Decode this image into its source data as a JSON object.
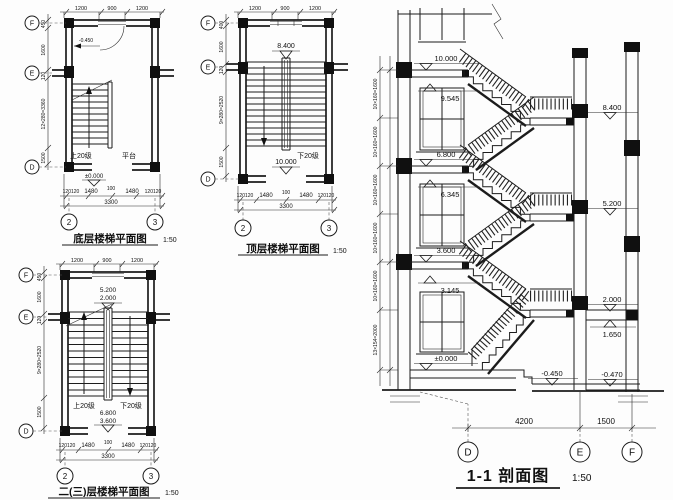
{
  "plans": {
    "ground": {
      "caption": "底层楼梯平面图",
      "scale": "1:50",
      "dims_top": [
        "1200",
        "900",
        "1200"
      ],
      "dims_left": [
        "450",
        "1600",
        "120",
        "12×280=3360",
        "1500"
      ],
      "dims_bottom": [
        "120120",
        "1480",
        "100",
        "1480",
        "120120"
      ],
      "dim_total": "3300",
      "axes_left": [
        "F",
        "E",
        "D"
      ],
      "axes_bottom": [
        "2",
        "3"
      ],
      "label_up": "上20级",
      "label_landing": "平台",
      "level_zero": "±0.000",
      "level_entry": "-0.450"
    },
    "top": {
      "caption": "顶层楼梯平面图",
      "scale": "1:50",
      "dims_top": [
        "1200",
        "900",
        "1200"
      ],
      "dims_left": [
        "400",
        "1600",
        "120",
        "9×280=2520",
        "1500"
      ],
      "dims_bottom": [
        "120120",
        "1480",
        "100",
        "1480",
        "120120"
      ],
      "dim_total": "3300",
      "axes_left": [
        "F",
        "E",
        "D"
      ],
      "axes_bottom": [
        "2",
        "3"
      ],
      "label_down": "下20级",
      "level_landing": "8.400",
      "level_floor": "10.000"
    },
    "middle": {
      "caption": "二(三)层楼梯平面图",
      "scale": "1:50",
      "dims_top": [
        "1200",
        "900",
        "1200"
      ],
      "dims_left": [
        "450",
        "1600",
        "120",
        "9×280=2520",
        "1500"
      ],
      "dims_bottom": [
        "120120",
        "1480",
        "100",
        "1480",
        "120120"
      ],
      "dim_total": "3300",
      "axes_left": [
        "F",
        "E",
        "D"
      ],
      "axes_bottom": [
        "2",
        "3"
      ],
      "label_up": "上20级",
      "label_down": "下20级",
      "levels_top": [
        "5.200",
        "2.000"
      ],
      "levels_bottom": [
        "6.800",
        "3.600"
      ]
    }
  },
  "section": {
    "caption": "1-1 剖面图",
    "scale": "1:50",
    "levels_left": [
      "10.000",
      "9.545",
      "6.800",
      "6.345",
      "3.600",
      "3.145",
      "±0.000"
    ],
    "levels_right": [
      "8.400",
      "5.200",
      "2.000",
      "1.650",
      "-0.470"
    ],
    "level_outdoor": "-0.450",
    "dims_left": [
      "10×160=1600",
      "10×160=1600",
      "10×160=1600",
      "10×160=1600",
      "10×160=1600",
      "13×154=2000"
    ],
    "dims_bottom": [
      "4200",
      "1500"
    ],
    "axes": [
      "D",
      "E",
      "F"
    ]
  }
}
